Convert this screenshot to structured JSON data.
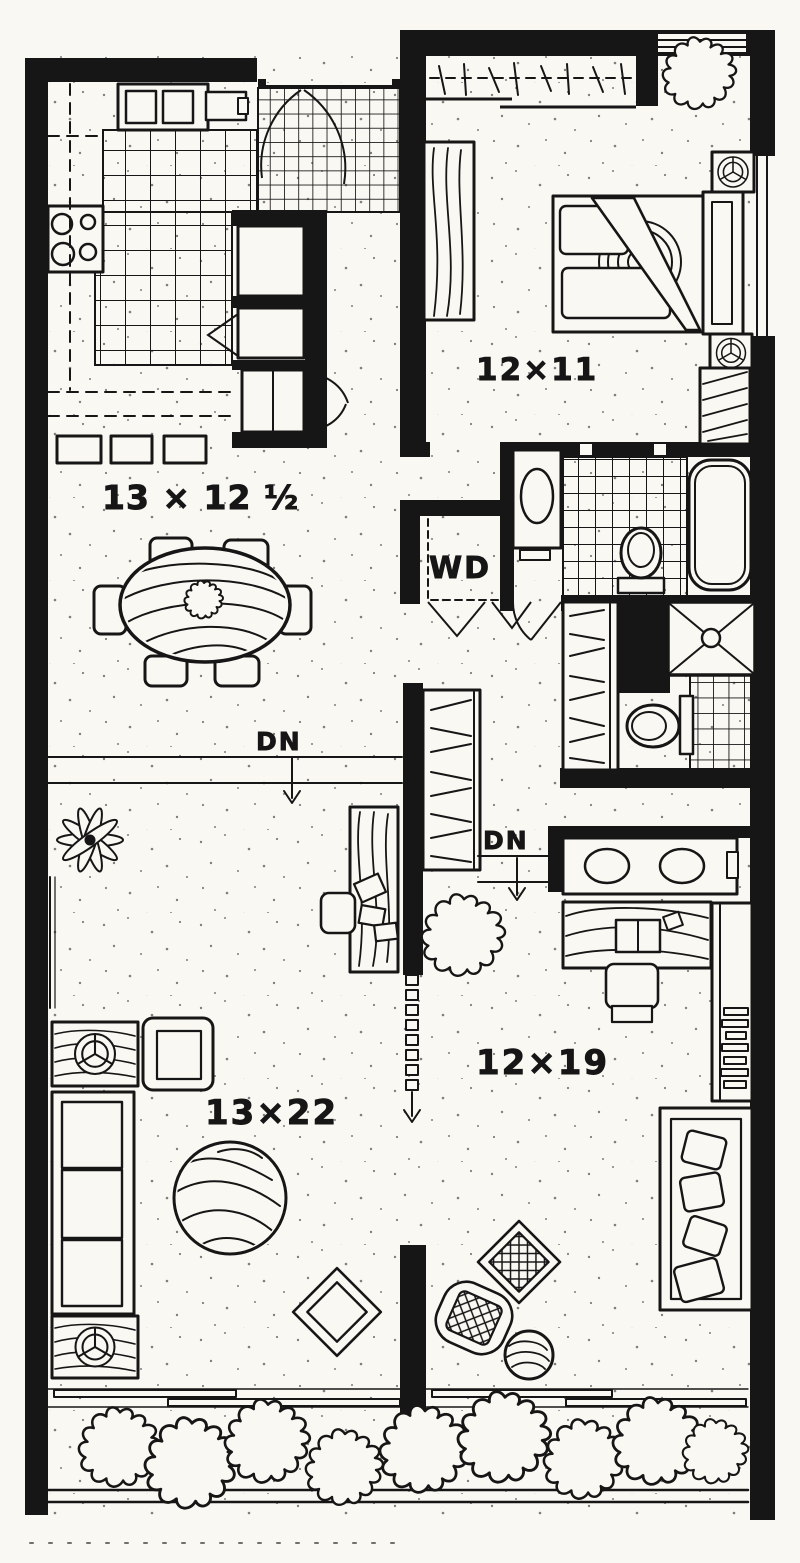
{
  "colors": {
    "ink": "#161616",
    "paper": "#faf8f3"
  },
  "labels": {
    "dining": "13 × 12 ½",
    "bedroom": "12×11",
    "laundry": "WD",
    "stairs_down_upper": "DN",
    "stairs_down_lower": "DN",
    "living": "13×22",
    "den": "12×19"
  }
}
